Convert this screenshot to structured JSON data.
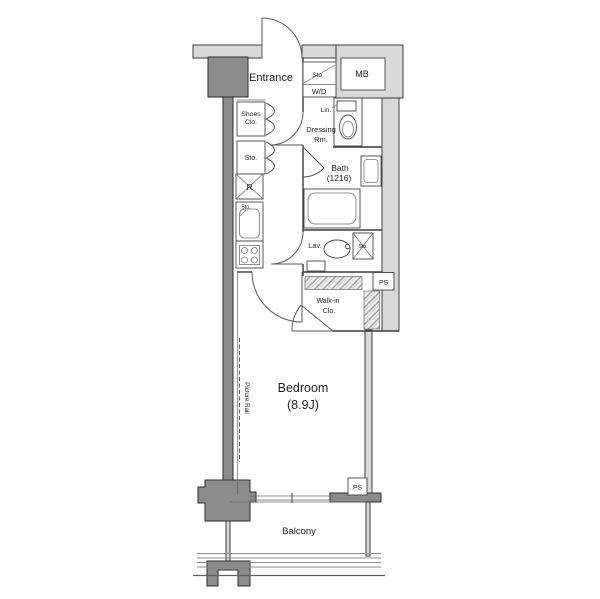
{
  "floorplan": {
    "title": "apartment-floor-plan",
    "labels": {
      "entrance": "Entrance",
      "storage_top": "Sto.",
      "washer_dryer": "W/D",
      "meter_box": "MB",
      "shoes_closet_line1": "Shoes",
      "shoes_closet_line2": "Clo.",
      "storage_left": "Sto.",
      "linen": "Lin.",
      "dressing_room_line1": "Dressing",
      "dressing_room_line2": "Rm.",
      "bath_line1": "Bath",
      "bath_line2": "(1216)",
      "refrigerator": "R",
      "storage_kitchen": "Sto.",
      "lavatory": "Lav.",
      "storage_lavatory": "Sto.",
      "pipe_space_upper": "PS",
      "walk_in_closet_line1": "Walk-in",
      "walk_in_closet_line2": "Clo.",
      "bedroom_line1": "Bedroom",
      "bedroom_line2": "(8.9J)",
      "picture_rail": "Picture Rail",
      "pipe_space_lower": "PS",
      "balcony": "Balcony"
    },
    "colors": {
      "wall_light": "#d8d8d8",
      "wall_dark": "#8c8c8c",
      "hatch_bg": "#f4f4f4",
      "white": "#ffffff"
    }
  }
}
